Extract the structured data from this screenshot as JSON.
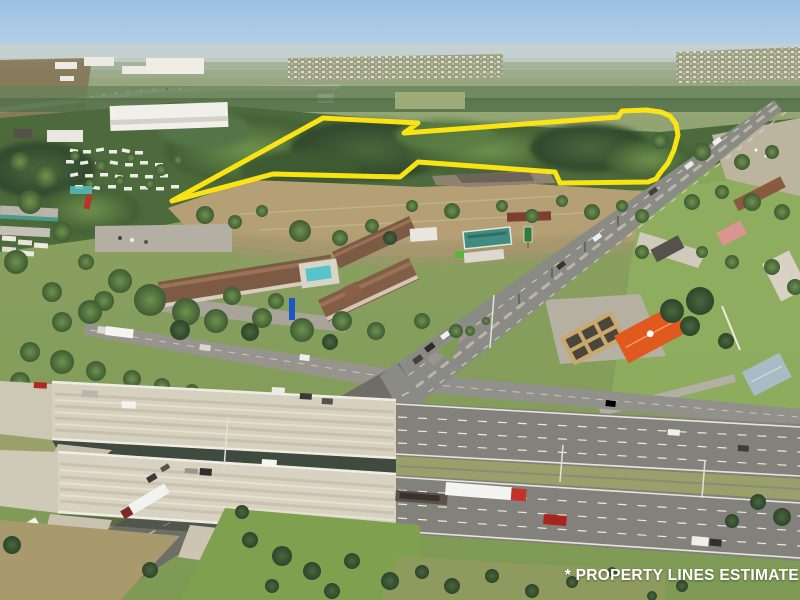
{
  "photo": {
    "kind": "aerial-drone-photo",
    "subject": "commercial land parcel beside interstate interchange"
  },
  "annotation": {
    "disclaimer": "* PROPERTY LINES ESTIMATE",
    "disclaimer_color": "#ffffff"
  },
  "property_outline": {
    "color": "#ffe712",
    "stroke_width": 5,
    "points": [
      [
        323,
        118
      ],
      [
        418,
        123
      ],
      [
        404,
        133
      ],
      [
        618,
        117
      ],
      [
        622,
        111
      ],
      [
        646,
        110
      ],
      [
        661,
        112
      ],
      [
        670,
        116
      ],
      [
        676,
        124
      ],
      [
        678,
        135
      ],
      [
        674,
        150
      ],
      [
        668,
        163
      ],
      [
        660,
        173
      ],
      [
        656,
        179
      ],
      [
        648,
        182
      ],
      [
        560,
        183
      ],
      [
        555,
        172
      ],
      [
        418,
        162
      ],
      [
        400,
        177
      ],
      [
        273,
        174
      ],
      [
        172,
        201
      ]
    ]
  },
  "scene": {
    "colors": {
      "sky_top": "#a2c4e6",
      "sky_horizon": "#d4e2ea",
      "forest": "#4d6a3c",
      "scrub": "#b5a075",
      "grass": "#8fae5e",
      "asphalt": "#8b8b85",
      "concrete_bridge": "#d6d0bf",
      "motel_roof": "#7d5a44",
      "pool_water": "#56c4c8",
      "teal_roof": "#3e8d80",
      "orange_roof": "#e05a20",
      "gray_blue_roof": "#a9bcc6",
      "derelict_canopy": "#c9a96b",
      "semi_cab_red": "#c23227"
    },
    "features": [
      "wooded parcel outlined in yellow",
      "mobile home park",
      "warehouse",
      "motel complex with pool",
      "gas stations and restaurants",
      "divided arterial road",
      "interstate highway with overpass bridges",
      "semi trucks and cars"
    ]
  }
}
